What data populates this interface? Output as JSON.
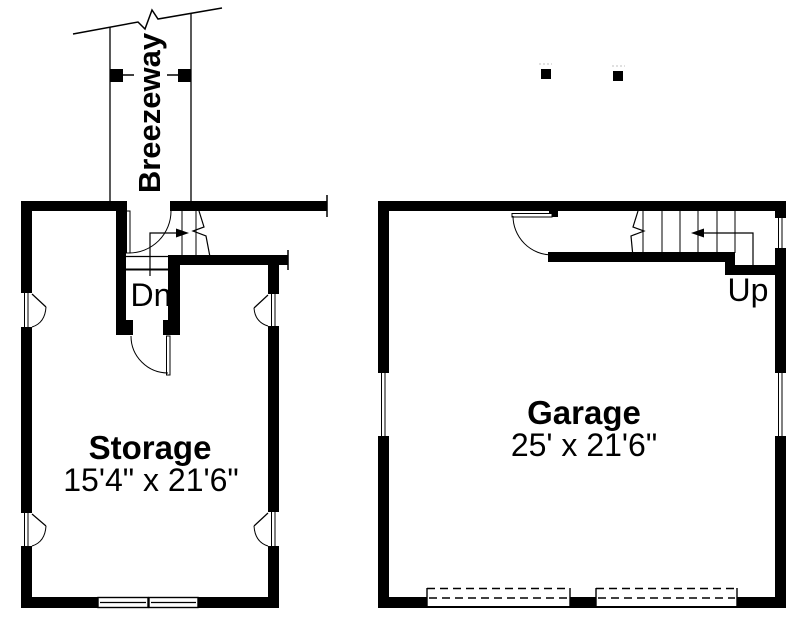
{
  "plan": {
    "title": "Garage floor plan with storage and breezeway",
    "breezeway": {
      "label": "Breezeway"
    },
    "storage": {
      "name": "Storage",
      "dimensions": "15'4\" x 21'6\""
    },
    "garage": {
      "name": "Garage",
      "dimensions": "25' x 21'6\""
    },
    "stairs": {
      "down_label": "Dn",
      "up_label": "Up"
    }
  },
  "colors": {
    "line": "#000000",
    "background": "#ffffff",
    "faint": "#c0c0c0"
  }
}
